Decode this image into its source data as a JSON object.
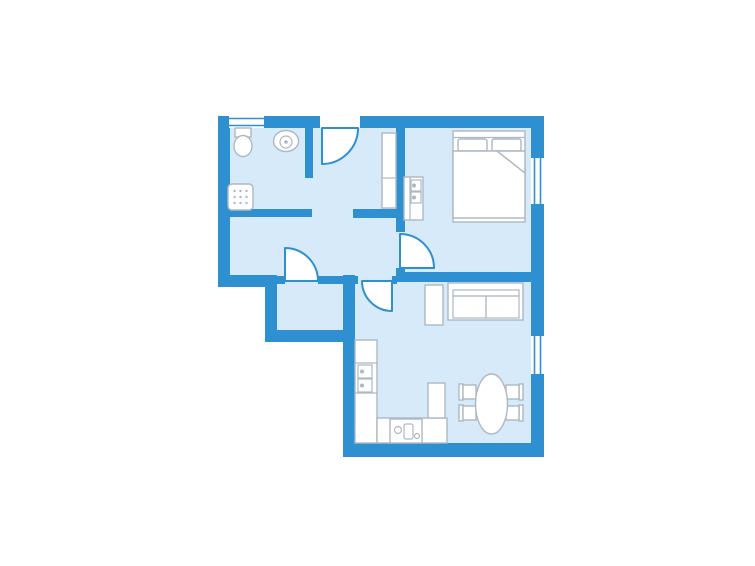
{
  "page": {
    "title": "Apartment floor plan",
    "type": "architectural-floor-plan",
    "background": "#FFFFFF"
  },
  "colors": {
    "wall": "#2E90D1",
    "floor": "#D6EAF9",
    "fixfill": "#FFFFFF",
    "fixline": "#ADB8C3",
    "doorfill": "#FFFFFF",
    "doorline": "#2E90D1",
    "winfill": "#FFFFFF",
    "winline": "#2E90D1",
    "bg": "#FFFFFF"
  },
  "rooms": [
    {
      "name": "bathroom",
      "position": "top-left"
    },
    {
      "name": "hall",
      "position": "center-left"
    },
    {
      "name": "bedroom",
      "position": "top-right"
    },
    {
      "name": "vestibule",
      "position": "bottom-left"
    },
    {
      "name": "living-room-kitchen",
      "position": "bottom-right"
    }
  ],
  "doors": [
    {
      "name": "entry-door",
      "wall": "top",
      "swing": "inward-left-hinge"
    },
    {
      "name": "bedroom-door",
      "wall": "bedroom-west",
      "swing": "into-bedroom"
    },
    {
      "name": "vestibule-door",
      "wall": "hall-south",
      "swing": "into-hall"
    },
    {
      "name": "living-room-door",
      "wall": "hall-south",
      "swing": "into-living-room"
    }
  ],
  "windows": [
    {
      "name": "bathroom-window",
      "wall": "top"
    },
    {
      "name": "bedroom-window",
      "wall": "right"
    },
    {
      "name": "living-room-window",
      "wall": "right"
    }
  ],
  "fixtures": [
    {
      "name": "toilet",
      "room": "bathroom"
    },
    {
      "name": "washbasin",
      "room": "bathroom"
    },
    {
      "name": "shower",
      "room": "bathroom"
    },
    {
      "name": "wardrobe",
      "room": "hall"
    },
    {
      "name": "vanity-unit",
      "room": "bedroom"
    },
    {
      "name": "double-bed",
      "room": "bedroom",
      "details": [
        "headboard",
        "two-pillows",
        "blanket-with-folded-corner"
      ]
    },
    {
      "name": "sofa",
      "room": "living-room-kitchen",
      "details": [
        "two-seat-cushions"
      ]
    },
    {
      "name": "side-table",
      "room": "living-room-kitchen"
    },
    {
      "name": "kitchen-counter-L",
      "room": "living-room-kitchen"
    },
    {
      "name": "kitchen-sink",
      "room": "living-room-kitchen"
    },
    {
      "name": "stove",
      "room": "living-room-kitchen"
    },
    {
      "name": "tall-cabinet",
      "room": "living-room-kitchen"
    },
    {
      "name": "dining-table-oval",
      "room": "living-room-kitchen"
    },
    {
      "name": "dining-chairs",
      "room": "living-room-kitchen",
      "count": 4
    }
  ]
}
